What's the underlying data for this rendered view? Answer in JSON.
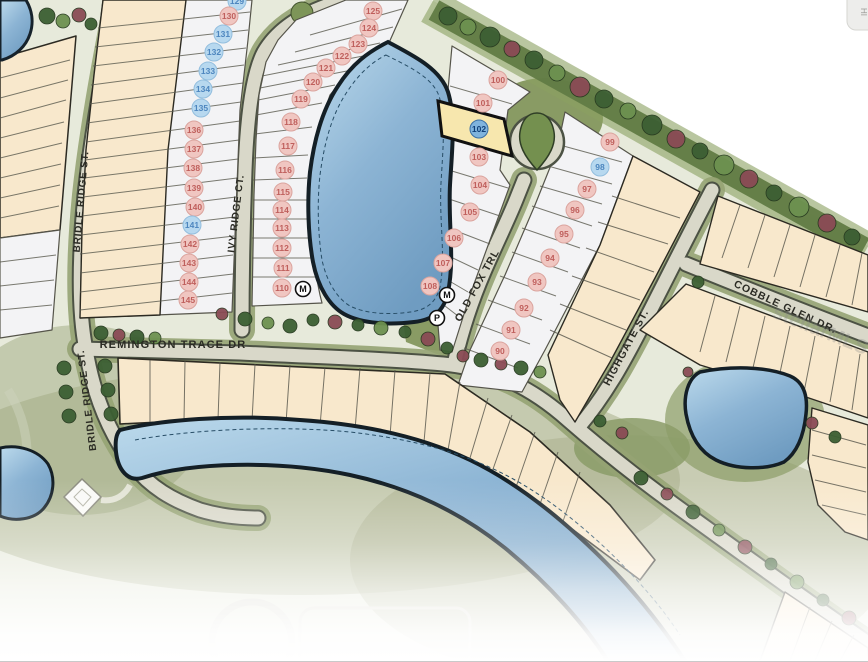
{
  "map": {
    "title": "subdivision-site-plan",
    "street_labels": [
      {
        "id": "bridle-ridge-st-upper",
        "text": "BRIDLE RIDGE ST.",
        "x": 84,
        "y": 202,
        "rot": -85,
        "fs": 10,
        "ls": 0.8
      },
      {
        "id": "bridle-ridge-st-lower",
        "text": "BRIDLE RIDGE ST.",
        "x": 90,
        "y": 400,
        "rot": -97,
        "fs": 10,
        "ls": 0.8
      },
      {
        "id": "ivy-ridge-ct",
        "text": "IVY RIDGE CT.",
        "x": 239,
        "y": 214,
        "rot": -83,
        "fs": 10,
        "ls": 0.8
      },
      {
        "id": "remington-trace-dr",
        "text": "REMINGTON TRACE DR",
        "x": 173,
        "y": 348,
        "rot": 0,
        "fs": 11,
        "ls": 1.1
      },
      {
        "id": "old-fox-trl",
        "text": "OLD FOX TRL",
        "x": 480,
        "y": 287,
        "rot": -61,
        "fs": 10.5,
        "ls": 1
      },
      {
        "id": "highgate-st",
        "text": "HIGHGATE ST.",
        "x": 629,
        "y": 349,
        "rot": -62,
        "fs": 10.5,
        "ls": 1
      },
      {
        "id": "cobble-glen-dr",
        "text": "COBBLE GLEN DR.",
        "x": 784,
        "y": 310,
        "rot": 25,
        "fs": 10.5,
        "ls": 1
      }
    ],
    "lots": [
      {
        "n": "129",
        "x": 237,
        "y": 1,
        "c": "b"
      },
      {
        "n": "130",
        "x": 229,
        "y": 16,
        "c": "p"
      },
      {
        "n": "131",
        "x": 223,
        "y": 34,
        "c": "b"
      },
      {
        "n": "132",
        "x": 214,
        "y": 52,
        "c": "b"
      },
      {
        "n": "133",
        "x": 208,
        "y": 71,
        "c": "b"
      },
      {
        "n": "134",
        "x": 203,
        "y": 89,
        "c": "b"
      },
      {
        "n": "135",
        "x": 201,
        "y": 108,
        "c": "b"
      },
      {
        "n": "136",
        "x": 194,
        "y": 130,
        "c": "p"
      },
      {
        "n": "137",
        "x": 194,
        "y": 149,
        "c": "p"
      },
      {
        "n": "138",
        "x": 193,
        "y": 168,
        "c": "p"
      },
      {
        "n": "139",
        "x": 194,
        "y": 188,
        "c": "p"
      },
      {
        "n": "140",
        "x": 195,
        "y": 207,
        "c": "p"
      },
      {
        "n": "141",
        "x": 192,
        "y": 225,
        "c": "b"
      },
      {
        "n": "142",
        "x": 190,
        "y": 244,
        "c": "p"
      },
      {
        "n": "143",
        "x": 189,
        "y": 263,
        "c": "p"
      },
      {
        "n": "144",
        "x": 189,
        "y": 282,
        "c": "p"
      },
      {
        "n": "145",
        "x": 188,
        "y": 300,
        "c": "p"
      },
      {
        "n": "125",
        "x": 373,
        "y": 11,
        "c": "p"
      },
      {
        "n": "124",
        "x": 369,
        "y": 28,
        "c": "p"
      },
      {
        "n": "123",
        "x": 358,
        "y": 44,
        "c": "p"
      },
      {
        "n": "122",
        "x": 342,
        "y": 56,
        "c": "p"
      },
      {
        "n": "121",
        "x": 326,
        "y": 68,
        "c": "p"
      },
      {
        "n": "120",
        "x": 313,
        "y": 82,
        "c": "p"
      },
      {
        "n": "119",
        "x": 301,
        "y": 99,
        "c": "p"
      },
      {
        "n": "118",
        "x": 291,
        "y": 122,
        "c": "p"
      },
      {
        "n": "117",
        "x": 288,
        "y": 146,
        "c": "p"
      },
      {
        "n": "116",
        "x": 285,
        "y": 170,
        "c": "p"
      },
      {
        "n": "115",
        "x": 283,
        "y": 192,
        "c": "p"
      },
      {
        "n": "114",
        "x": 282,
        "y": 210,
        "c": "p"
      },
      {
        "n": "113",
        "x": 282,
        "y": 228,
        "c": "p"
      },
      {
        "n": "112",
        "x": 282,
        "y": 248,
        "c": "p"
      },
      {
        "n": "111",
        "x": 283,
        "y": 268,
        "c": "p"
      },
      {
        "n": "110",
        "x": 282,
        "y": 288,
        "c": "p"
      },
      {
        "n": "100",
        "x": 498,
        "y": 80,
        "c": "p"
      },
      {
        "n": "101",
        "x": 483,
        "y": 103,
        "c": "p"
      },
      {
        "n": "102",
        "x": 479,
        "y": 129,
        "c": "h"
      },
      {
        "n": "103",
        "x": 479,
        "y": 157,
        "c": "p"
      },
      {
        "n": "104",
        "x": 480,
        "y": 185,
        "c": "p"
      },
      {
        "n": "105",
        "x": 470,
        "y": 212,
        "c": "p"
      },
      {
        "n": "106",
        "x": 454,
        "y": 238,
        "c": "p"
      },
      {
        "n": "107",
        "x": 443,
        "y": 263,
        "c": "p"
      },
      {
        "n": "108",
        "x": 430,
        "y": 286,
        "c": "p"
      },
      {
        "n": "99",
        "x": 610,
        "y": 142,
        "c": "p"
      },
      {
        "n": "98",
        "x": 600,
        "y": 167,
        "c": "b"
      },
      {
        "n": "97",
        "x": 587,
        "y": 189,
        "c": "p"
      },
      {
        "n": "96",
        "x": 575,
        "y": 210,
        "c": "p"
      },
      {
        "n": "95",
        "x": 564,
        "y": 234,
        "c": "p"
      },
      {
        "n": "94",
        "x": 550,
        "y": 258,
        "c": "p"
      },
      {
        "n": "93",
        "x": 537,
        "y": 282,
        "c": "p"
      },
      {
        "n": "92",
        "x": 524,
        "y": 308,
        "c": "p"
      },
      {
        "n": "91",
        "x": 511,
        "y": 330,
        "c": "p"
      },
      {
        "n": "90",
        "x": 500,
        "y": 351,
        "c": "p"
      }
    ],
    "amenity_markers": [
      {
        "t": "M",
        "x": 303,
        "y": 289
      },
      {
        "t": "M",
        "x": 447,
        "y": 295
      },
      {
        "t": "P",
        "x": 437,
        "y": 318
      }
    ],
    "highlighted_lot": "102",
    "watermark": "stellarMLS",
    "corner_tab": "HI"
  },
  "colors": {
    "lot_tan": "#f8e8cc",
    "lot_white": "#f3f3f5",
    "road_fill": "#d9d8c9",
    "road_edge": "#4c5244",
    "verge_green": "#96a474",
    "buffer_green": "#617b44",
    "pond_light": "#b9d9eb",
    "pond_dark": "#74a3c7",
    "pond_outline": "#16222b",
    "highlight_lot_fill": "#f7e7ae",
    "pink_badge_fill": "#f0c6c1",
    "pink_badge_stroke": "#dba49e",
    "pink_badge_text": "#bf5f5c",
    "blue_badge_fill": "#b7d8ef",
    "blue_badge_stroke": "#93bede",
    "blue_badge_text": "#4d86bf",
    "highlight_badge_fill": "#7fb3dd",
    "highlight_badge_stroke": "#3a6fa5",
    "highlight_badge_text": "#0f3f78"
  }
}
